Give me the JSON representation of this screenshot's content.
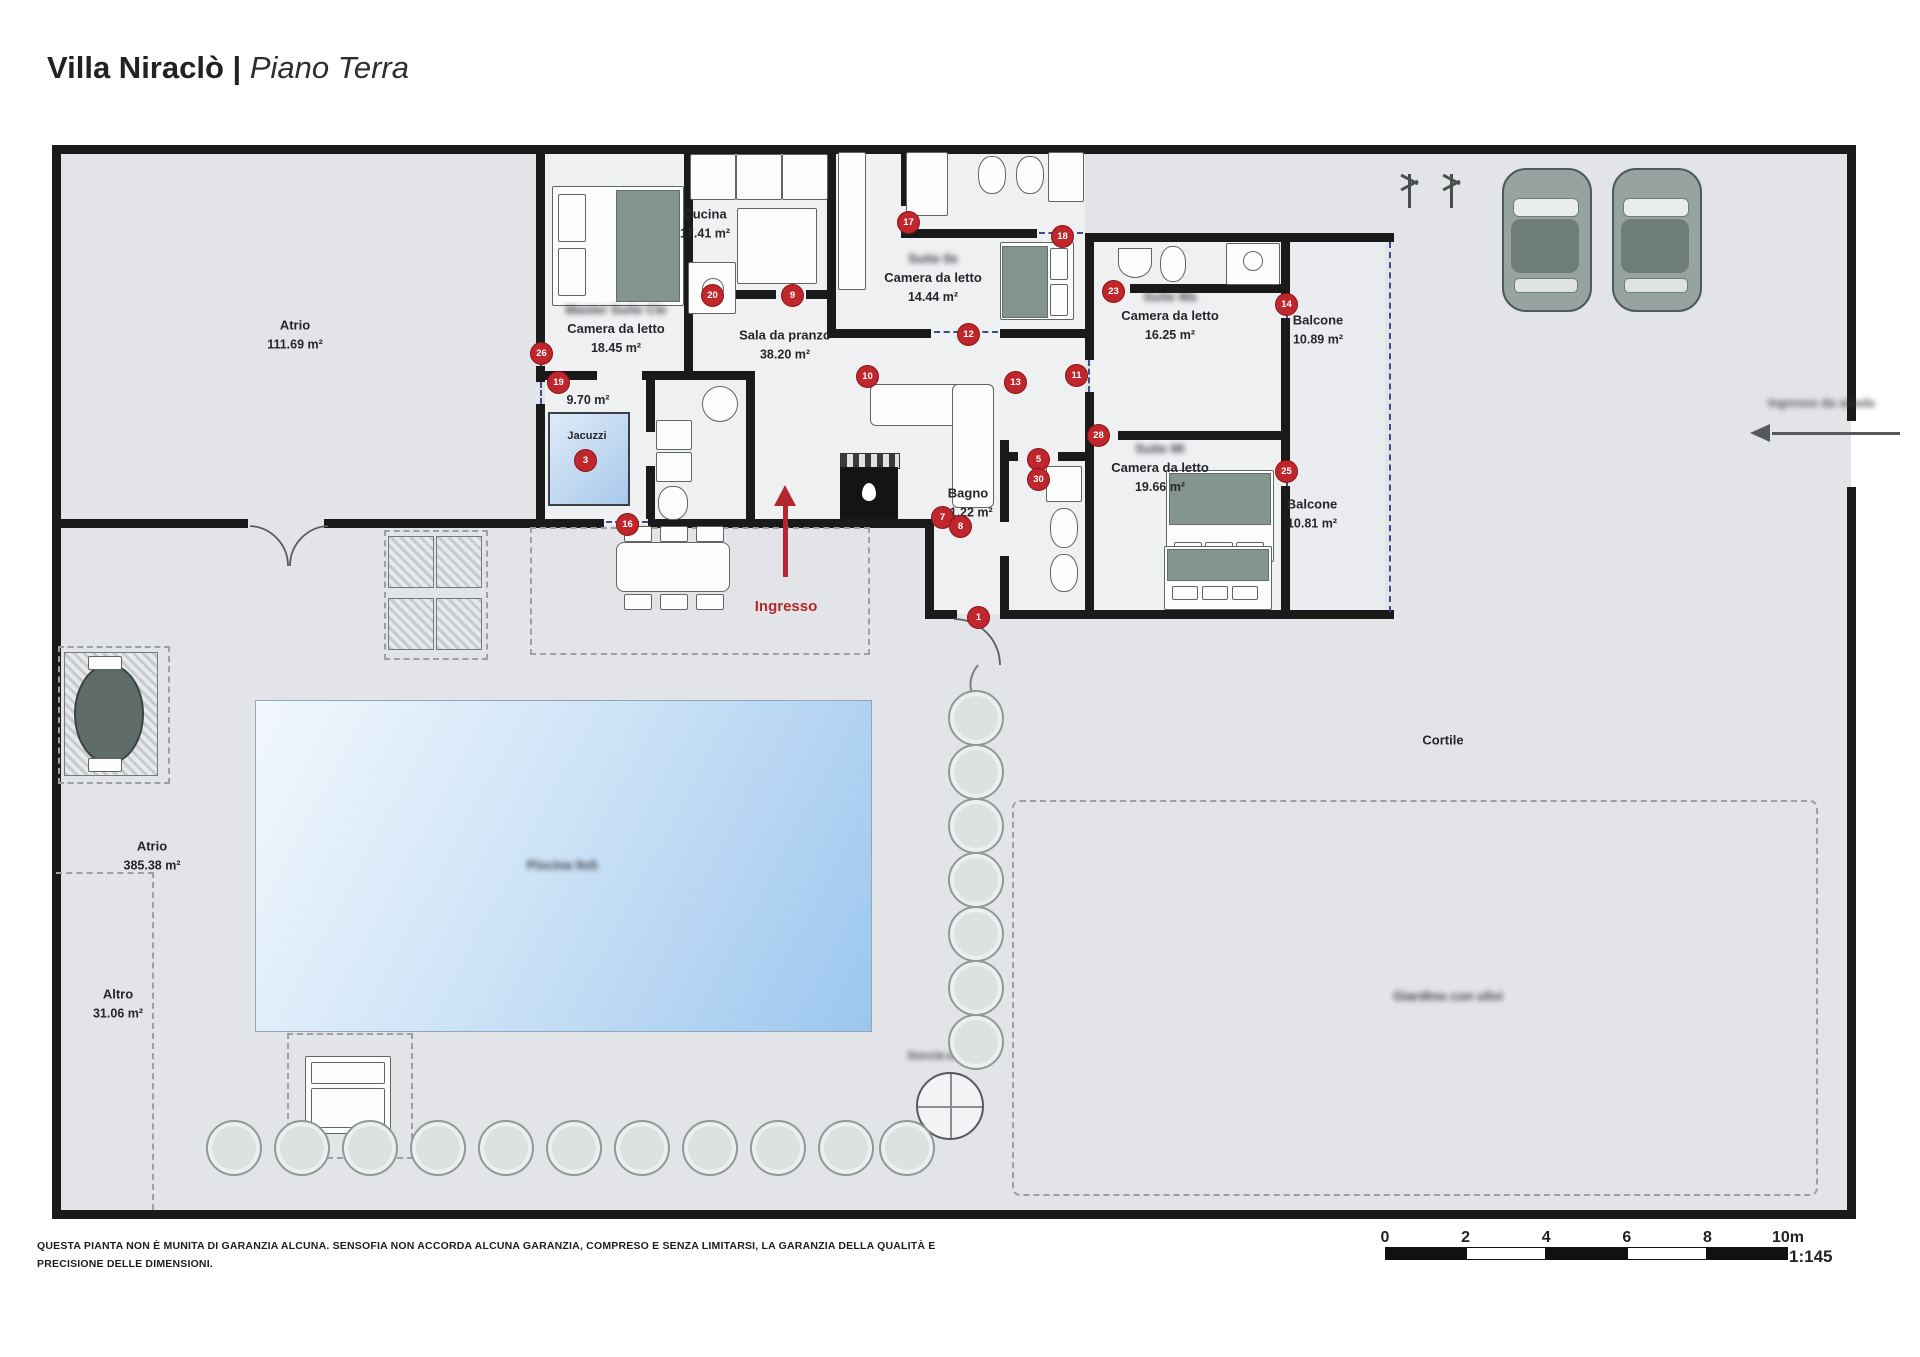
{
  "title": {
    "name": "Villa Niraclò",
    "divider": "|",
    "floor": "Piano Terra"
  },
  "rooms": {
    "atrio_main": {
      "name": "Atrio",
      "area": "111.69 m²"
    },
    "cucina": {
      "name": "Cucina",
      "area": "17.41 m²"
    },
    "camera_master": {
      "suite": "Master Suite Cle",
      "name": "Camera da letto",
      "area": "18.45 m²"
    },
    "sala_pranzo": {
      "name": "Sala da pranzo",
      "area": "38.20 m²"
    },
    "camera_2": {
      "suite": "Suite Ile",
      "name": "Camera da letto",
      "area": "14.44 m²"
    },
    "camera_3": {
      "suite": "Suite Ma",
      "name": "Camera da letto",
      "area": "16.25 m²"
    },
    "balcone_1": {
      "name": "Balcone",
      "area": "10.89 m²"
    },
    "camera_4": {
      "suite": "Suite Mi",
      "name": "Camera da letto",
      "area": "19.66 m²"
    },
    "balcone_2": {
      "name": "Balcone",
      "area": "10.81 m²"
    },
    "bagno": {
      "name": "Bagno",
      "area": "11.22 m²"
    },
    "disimpegno": {
      "area": "9.70 m²"
    },
    "jacuzzi": {
      "name": "Jacuzzi"
    },
    "atrio_2": {
      "name": "Atrio",
      "area": "385.38 m²"
    },
    "altro": {
      "name": "Altro",
      "area": "31.06 m²"
    },
    "cortile": {
      "name": "Cortile"
    },
    "giardino": {
      "name": "Giardino con ulivi"
    },
    "piscina": {
      "name": "Piscina 9x5"
    },
    "doccia": {
      "name": "Doccia esterna"
    }
  },
  "annotations": {
    "ingresso": "Ingresso",
    "ingresso_strada": "Ingresso da strada"
  },
  "badges": [
    {
      "n": "26",
      "x": 540,
      "y": 352
    },
    {
      "n": "19",
      "x": 557,
      "y": 381
    },
    {
      "n": "3",
      "x": 584,
      "y": 459
    },
    {
      "n": "16",
      "x": 626,
      "y": 523
    },
    {
      "n": "20",
      "x": 711,
      "y": 294
    },
    {
      "n": "9",
      "x": 791,
      "y": 294
    },
    {
      "n": "17",
      "x": 907,
      "y": 221
    },
    {
      "n": "18",
      "x": 1061,
      "y": 235
    },
    {
      "n": "12",
      "x": 967,
      "y": 333
    },
    {
      "n": "10",
      "x": 866,
      "y": 375
    },
    {
      "n": "13",
      "x": 1014,
      "y": 381
    },
    {
      "n": "11",
      "x": 1075,
      "y": 374
    },
    {
      "n": "23",
      "x": 1112,
      "y": 290
    },
    {
      "n": "14",
      "x": 1285,
      "y": 303
    },
    {
      "n": "28",
      "x": 1097,
      "y": 434
    },
    {
      "n": "25",
      "x": 1285,
      "y": 470
    },
    {
      "n": "5",
      "x": 1037,
      "y": 458
    },
    {
      "n": "30",
      "x": 1037,
      "y": 478
    },
    {
      "n": "7",
      "x": 941,
      "y": 516
    },
    {
      "n": "8",
      "x": 959,
      "y": 525
    },
    {
      "n": "1",
      "x": 977,
      "y": 616
    }
  ],
  "scale_bar": {
    "ticks": [
      "0",
      "2",
      "4",
      "6",
      "8",
      "10m"
    ],
    "ratio": "1:145"
  },
  "disclaimer": {
    "line1": "QUESTA PIANTA NON È MUNITA DI GARANZIA ALCUNA. SENSOFIA NON ACCORDA ALCUNA GARANZIA, COMPRESO E SENZA LIMITARSI, LA GARANZIA DELLA QUALITÀ E",
    "line2": "PRECISIONE DELLE DIMENSIONI."
  },
  "colors": {
    "badge_red": "#c0272d",
    "accent_red": "#b3282d",
    "wall": "#1a1a1a",
    "site_gray": "#e3e4e8",
    "pool_blue": "#9cc6ee"
  }
}
